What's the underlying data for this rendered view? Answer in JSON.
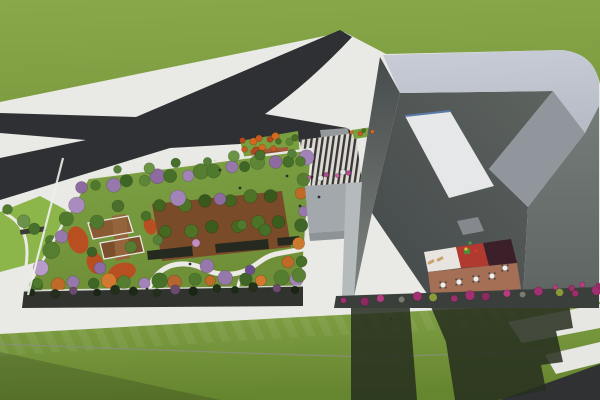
{
  "meta": {
    "title": "Aerial 3D architectural rendering",
    "description": "Bird's-eye render of a site: X-shaped asphalt road junction upper-left on a green field, a rectangular rooftop-garden podium with orchard bed, pavilion and winding path, a striped entry plaza, and a large angular gray building with skylight and sunken terrace (cafe tables, loungers, red play floor); lawns with building shadow below.",
    "visible_text": []
  },
  "palette": {
    "paving": "#e9e9e5",
    "grass": "#7d9d40",
    "grass2": "#88a84a",
    "asphalt": "#2e3033",
    "ramp": "#96999b",
    "stripeDark": "#35353a",
    "stripeLight": "#ded9cf",
    "entryLawn": "#79a03e",
    "westLawn": "#8cb54a",
    "tier1": "#a35a36",
    "tier2": "#8a4a2e",
    "tier3": "#c9803f",
    "kiosk": "#3a3d3f",
    "bench": "#3a3d35",
    "gardenLawn": "#6f8f38",
    "gardenLawn2": "#7ea344",
    "bed": "#7a4b28",
    "seatwall": "#26291f",
    "deckA": "#8a5a33",
    "deckB": "#7d4e2b",
    "deckC": "#94653c",
    "path": "#eceae4",
    "border": "#e8e8e3",
    "curb": "#eef0ea",
    "redbed": "#c2461c",
    "podium": "#30332e",
    "podiumEdge": "#d8d8d2",
    "lawn": "#83a347",
    "lawnDark": "#66852f",
    "lawnLine": "#8b8e85",
    "walkSE": "#e6e6e2",
    "asphaltSE": "#2f3132",
    "shadow": "#262e1f",
    "canopy": "#a3a8ac",
    "fascia": "#8e9396",
    "westWall1": "#464b4c",
    "westWall2": "#7e847f",
    "pillar": "#b5babd",
    "bandLight": "#c9cdd8",
    "bandLight2": "#b7bdc7",
    "faceA": "#90969b",
    "faceB1": "#757b78",
    "faceB2": "#5f6562",
    "roofDark1": "#5d635e",
    "roofDark2": "#43484a",
    "skylight": "#e6e7e8",
    "glazing": "#5b79a8",
    "vent": "#85898d",
    "ctyWhite": "#e8e4df",
    "ctyRed": "#b03a30",
    "ctyMaroon": "#3c2029",
    "ctyDeck": "#a56f55",
    "baseBand": "#3a3f3c",
    "tableTop": "#f0f0ee",
    "chair": "#4a4a4a",
    "lounger": "#c9a26b",
    "person": "#2e2e2e"
  },
  "vegetation_rows": [
    {
      "name": "garden-top-row",
      "target": "g-garden-trees",
      "from": [
        98,
        186
      ],
      "to": [
        304,
        158
      ],
      "count": 15,
      "rmin": 5,
      "rmax": 8,
      "colors": [
        "#4f7a2e",
        "#9678ab",
        "#3f6626",
        "#5d8636",
        "#8d6ba1",
        "#466f28",
        "#a183b8",
        "#557e30"
      ]
    },
    {
      "name": "garden-street-row",
      "target": "g-street-trees",
      "from": [
        120,
        170
      ],
      "to": [
        290,
        152
      ],
      "count": 7,
      "rmin": 4,
      "rmax": 6,
      "colors": [
        "#54803a",
        "#6b9444",
        "#47702c"
      ]
    },
    {
      "name": "garden-left-row",
      "target": "g-garden-trees",
      "from": [
        84,
        188
      ],
      "to": [
        34,
        284
      ],
      "count": 7,
      "rmin": 6,
      "rmax": 9,
      "colors": [
        "#8d6ba1",
        "#a98bc0",
        "#4f7a2e",
        "#9678ab",
        "#557e30",
        "#b79ccb",
        "#466f28"
      ]
    },
    {
      "name": "garden-bottom-row",
      "target": "g-garden-trees",
      "from": [
        40,
        284
      ],
      "to": [
        296,
        278
      ],
      "count": 16,
      "rmin": 5,
      "rmax": 8,
      "colors": [
        "#4f7a2e",
        "#c06a28",
        "#9678ab",
        "#3f6626",
        "#d2782f",
        "#557e30",
        "#a183b8",
        "#466f28",
        "#b5652f"
      ]
    },
    {
      "name": "garden-right-row",
      "target": "g-garden-trees",
      "from": [
        303,
        162
      ],
      "to": [
        299,
        276
      ],
      "count": 8,
      "rmin": 5,
      "rmax": 7,
      "colors": [
        "#4f7a2e",
        "#557e30",
        "#c06a28",
        "#9678ab",
        "#3f6626",
        "#cc7a30",
        "#466f28",
        "#588133"
      ]
    },
    {
      "name": "orchard-row-1",
      "target": "g-garden-trees",
      "from": [
        162,
        206
      ],
      "to": [
        272,
        196
      ],
      "count": 6,
      "rmin": 6,
      "rmax": 7,
      "colors": [
        "#41661f",
        "#4d7326",
        "#38591b"
      ]
    },
    {
      "name": "orchard-row-2",
      "target": "g-garden-trees",
      "from": [
        168,
        232
      ],
      "to": [
        280,
        222
      ],
      "count": 6,
      "rmin": 6,
      "rmax": 7,
      "colors": [
        "#44691f",
        "#4d7326",
        "#3a5c1c"
      ]
    },
    {
      "name": "entry-red-row-1",
      "target": "g-entry-trees",
      "from": [
        245,
        141
      ],
      "to": [
        275,
        138
      ],
      "count": 5,
      "rmin": 3,
      "rmax": 4,
      "colors": [
        "#b5471f",
        "#d2691e",
        "#c55a24"
      ]
    },
    {
      "name": "entry-red-row-2",
      "target": "g-entry-trees",
      "from": [
        247,
        150
      ],
      "to": [
        271,
        148
      ],
      "count": 4,
      "rmin": 3,
      "rmax": 4,
      "colors": [
        "#c55a24",
        "#b5471f",
        "#d2691e"
      ]
    },
    {
      "name": "entry-green-row",
      "target": "g-entry-trees",
      "from": [
        281,
        142
      ],
      "to": [
        296,
        139
      ],
      "count": 3,
      "rmin": 3,
      "rmax": 4,
      "colors": [
        "#4a7028",
        "#5d8636"
      ]
    },
    {
      "name": "west-park-trees",
      "target": "g-west-trees",
      "from": [
        10,
        210
      ],
      "to": [
        48,
        240
      ],
      "count": 4,
      "rmin": 5,
      "rmax": 7,
      "colors": [
        "#4f7a2e",
        "#6b924a",
        "#47702c"
      ]
    },
    {
      "name": "podium-hedge-row",
      "target": "g-hedges",
      "from": [
        34,
        293
      ],
      "to": [
        296,
        288
      ],
      "count": 14,
      "rmin": 3.5,
      "rmax": 5,
      "colors": [
        "#1d2917",
        "#24301b",
        "#6b4a6e",
        "#1a2514",
        "#22301a"
      ]
    },
    {
      "name": "building-shrub-row",
      "target": "g-shrubs",
      "from": [
        346,
        301
      ],
      "to": [
        594,
        291
      ],
      "count": 15,
      "rmin": 3,
      "rmax": 5,
      "colors": [
        "#a13070",
        "#8a2a5e",
        "#b53d7e",
        "#787c6e",
        "#a13070",
        "#8a9a3a",
        "#9c2f6b"
      ]
    },
    {
      "name": "bougainvillea-row",
      "target": "g-shrubs",
      "from": [
        558,
        288
      ],
      "to": [
        596,
        285
      ],
      "count": 4,
      "rmin": 2.5,
      "rmax": 3.5,
      "colors": [
        "#b53d7e",
        "#9c2f6b"
      ]
    },
    {
      "name": "plaza-flower-row",
      "target": "g-flowers",
      "from": [
        312,
        178
      ],
      "to": [
        350,
        173
      ],
      "count": 6,
      "rmin": 2,
      "rmax": 3,
      "colors": [
        "#c75fa0",
        "#e3e3e0",
        "#b54a90"
      ]
    },
    {
      "name": "verge-flower-row",
      "target": "g-flowers",
      "from": [
        354,
        133
      ],
      "to": [
        370,
        131
      ],
      "count": 4,
      "rmin": 1.8,
      "rmax": 2.6,
      "colors": [
        "#d2691e",
        "#c55a24",
        "#4a7028"
      ]
    }
  ],
  "scatter_trees": [
    [
      178,
      198,
      8,
      "#a183b8"
    ],
    [
      220,
      199,
      6,
      "#8d6ba1"
    ],
    [
      207,
      266,
      7,
      "#9678ab"
    ],
    [
      242,
      225,
      5,
      "#4f7a2e"
    ],
    [
      158,
      240,
      5,
      "#54803a"
    ],
    [
      265,
      230,
      6,
      "#466f28"
    ],
    [
      288,
      262,
      6,
      "#c06a28"
    ],
    [
      118,
      206,
      6,
      "#4a6e2c"
    ],
    [
      97,
      222,
      7,
      "#4f7a2e"
    ],
    [
      131,
      247,
      6,
      "#567c31"
    ],
    [
      92,
      252,
      5,
      "#3f6126"
    ],
    [
      250,
      270,
      5,
      "#6b4f8e"
    ],
    [
      196,
      243,
      4,
      "#bf8fc4"
    ],
    [
      100,
      268,
      6,
      "#8d6ba1"
    ],
    [
      146,
      216,
      5,
      "#497029"
    ]
  ],
  "terrace": {
    "tables": [
      [
        443,
        285
      ],
      [
        459,
        282
      ],
      [
        476,
        279
      ],
      [
        492,
        276
      ],
      [
        505,
        268
      ]
    ],
    "loungers": [
      [
        431,
        262
      ],
      [
        440,
        259
      ]
    ],
    "figures": [
      [
        470,
        243,
        "#3fa03f"
      ],
      [
        476,
        251,
        "#d23b2f"
      ],
      [
        466,
        249,
        "#e0c03a"
      ]
    ]
  },
  "people": [
    [
      312,
      177
    ],
    [
      319,
      197
    ],
    [
      300,
      206
    ],
    [
      268,
      290
    ],
    [
      190,
      264
    ],
    [
      147,
      289
    ],
    [
      391,
      319
    ],
    [
      240,
      188
    ],
    [
      287,
      176
    ],
    [
      220,
      170
    ]
  ]
}
